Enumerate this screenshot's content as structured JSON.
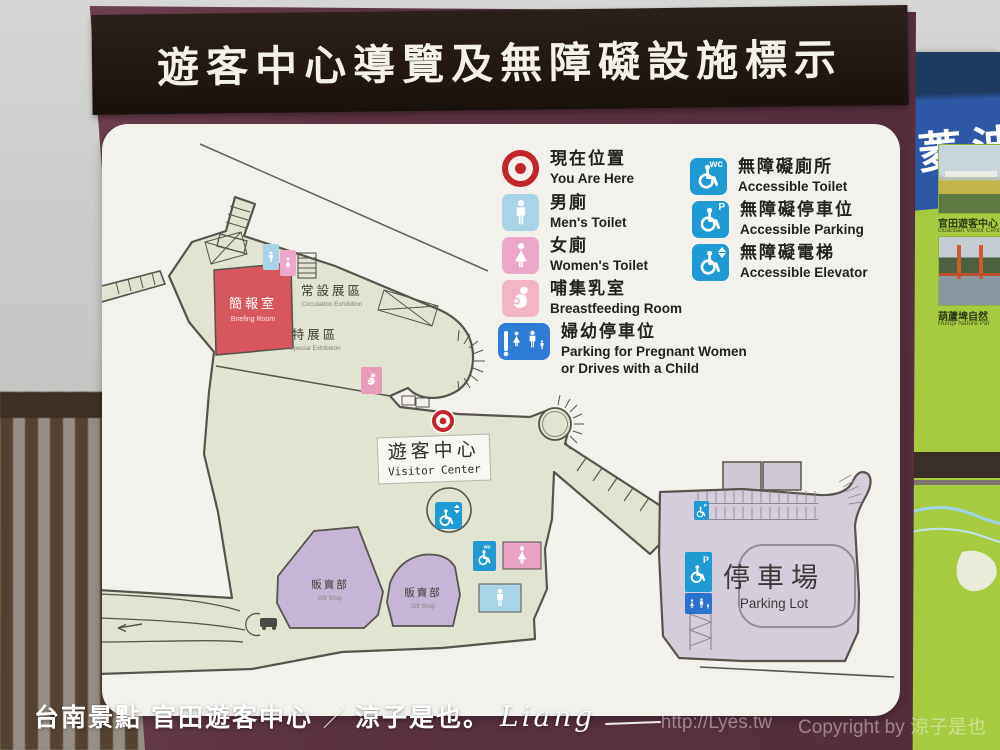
{
  "title": "遊客中心導覽及無障礙設施標示",
  "legend": {
    "items": [
      {
        "zh": "現在位置",
        "en": "You Are Here",
        "icon": "you-are-here-target"
      },
      {
        "zh": "男廁",
        "en": "Men's Toilet",
        "icon": "man"
      },
      {
        "zh": "女廁",
        "en": "Women's Toilet",
        "icon": "woman"
      },
      {
        "zh": "哺集乳室",
        "en": "Breastfeeding Room",
        "icon": "breastfeeding"
      },
      {
        "zh": "婦幼停車位",
        "en": "Parking for Pregnant Women",
        "en2": "or Drives with a Child",
        "icon": "family-parking"
      },
      {
        "zh": "無障礙廁所",
        "en": "Accessible Toilet",
        "icon": "wheelchair-wc",
        "badge": "wc"
      },
      {
        "zh": "無障礙停車位",
        "en": "Accessible Parking",
        "icon": "wheelchair-p",
        "badge": "P"
      },
      {
        "zh": "無障礙電梯",
        "en": "Accessible Elevator",
        "icon": "wheelchair-elevator"
      }
    ]
  },
  "map": {
    "rooms": {
      "briefing": {
        "zh": "簡報室",
        "en": "Briefing Room"
      },
      "permanent": {
        "zh": "常設展區",
        "en": "Circulation Exhibition"
      },
      "special": {
        "zh": "特展區",
        "en": "Special Exhibition"
      },
      "visitor_center": {
        "zh": "遊客中心",
        "en": "Visitor Center"
      },
      "gift_shop1": {
        "zh": "販賣部",
        "en": "Gift Shop"
      },
      "gift_shop2": {
        "zh": "販賣部",
        "en": "Gift Shop"
      },
      "parking": {
        "zh": "停車場",
        "en": "Parking Lot"
      }
    },
    "icon_badges": {
      "wc": "wc",
      "parking": "P"
    }
  },
  "side_sign": {
    "header": "菱波",
    "photos": [
      {
        "zh": "官田遊客中心",
        "en": "Guantian Visitor Cent"
      },
      {
        "zh": "葫蘆埤自然",
        "en": "Hulupi Nature Par"
      }
    ]
  },
  "footer": {
    "caption_location": "台南景點 官田遊客中心",
    "caption_separator": "／",
    "caption_author": "涼子是也。",
    "caption_signature": "Liang",
    "watermark_url": "http://Lyes.tw",
    "watermark_copyright": "Copyright by 涼子是也"
  },
  "colors": {
    "board_maroon": "#5e3443",
    "title_band": "#20160f",
    "panel_white": "#f2f1eb",
    "floor_green": "#e1e4d0",
    "outline_dark": "#57544b",
    "briefing_red": "#d8575f",
    "gift_purple": "#c6b5d7",
    "parking_lavender": "#d5cddb",
    "accessible_blue": "#1f9ad2",
    "family_blue": "#2f7cd6",
    "mens_blue": "#a9d4e8",
    "womens_pink": "#eca8ca",
    "target_red": "#c4242b",
    "side_sign_green": "#a6cb41",
    "side_sign_blue": "#2e57a5"
  }
}
